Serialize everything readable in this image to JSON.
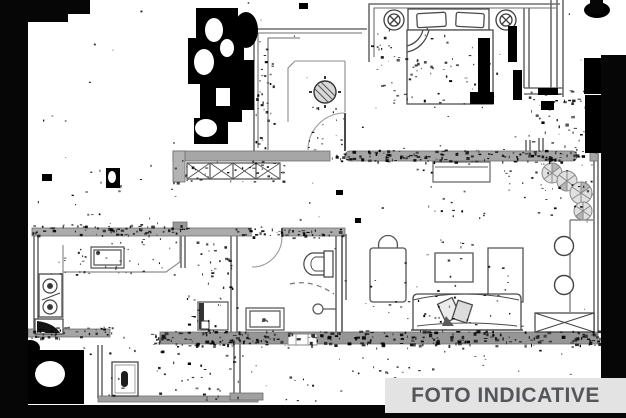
{
  "banner": {
    "label": "FOTO INDICATIVE"
  },
  "colors": {
    "banner-bg": "#e3e3e3",
    "banner-text": "#55565a",
    "scan-bar": "#060606",
    "paper": "#ffffff",
    "line": "#6e6e6e",
    "line-dark": "#404040",
    "wall-fill": "#a6a6a6"
  },
  "plan_icons": [
    "double-bed",
    "pillow",
    "nightstand-lamp",
    "wardrobe",
    "ceiling-fan",
    "door-swing",
    "radiator",
    "console-table",
    "plant",
    "stool",
    "sofa",
    "sofa-cushion",
    "coffee-table",
    "tv-cabinet",
    "armchair",
    "side-table",
    "kitchen-counter",
    "kitchen-sink",
    "stove",
    "corner-cabinet",
    "washing-machine",
    "toilet",
    "shower-drain",
    "bathroom-sink",
    "cabinet"
  ]
}
